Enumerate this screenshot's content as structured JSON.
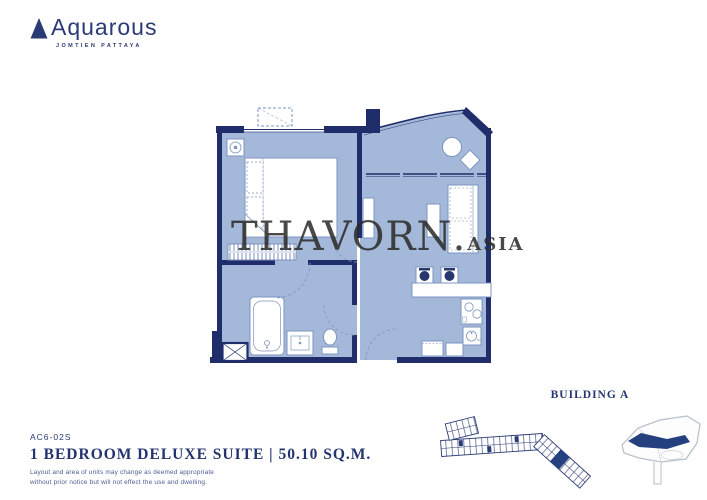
{
  "colors": {
    "navy": "#1f2d6b",
    "brand_navy": "#2a3a75",
    "floor_blue": "#a4b9da",
    "furniture_line": "#7e94bf",
    "watermark_gray": "#2b2a28",
    "site_outline": "#b6bfcc",
    "highlight_unit": "#24407f"
  },
  "logo": {
    "name": "Aquarous",
    "tagline": "JOMTIEN PATTAYA"
  },
  "watermark": {
    "brand": "THAVORN",
    "separator": ".",
    "tld": "ASIA"
  },
  "unit": {
    "code": "AC6-02S",
    "title": "1 BEDROOM DELUXE SUITE | 50.10 SQ.M.",
    "disclaimer_line1": "Layout and area of units may change as deemed appropriate",
    "disclaimer_line2": "without prior notice but will not effect the use and dwelling."
  },
  "building": {
    "label": "BUILDING A"
  },
  "floorplan": {
    "rooms": [
      "bedroom",
      "living-dining",
      "kitchen",
      "bathroom",
      "balcony"
    ],
    "furniture_icons": [
      "bed-icon",
      "wardrobe-icon",
      "ac-unit-icon",
      "condenser-icon",
      "tv-console-icon",
      "dining-table-icon",
      "sofa-icon",
      "balcony-table-icon",
      "balcony-chair-icon",
      "kitchen-counter-icon",
      "canister-icon",
      "stove-icon",
      "kitchen-sink-icon",
      "cabinet-icon",
      "bathtub-icon",
      "basin-icon",
      "toilet-icon",
      "service-shaft-icon",
      "door-swing-arc"
    ]
  }
}
